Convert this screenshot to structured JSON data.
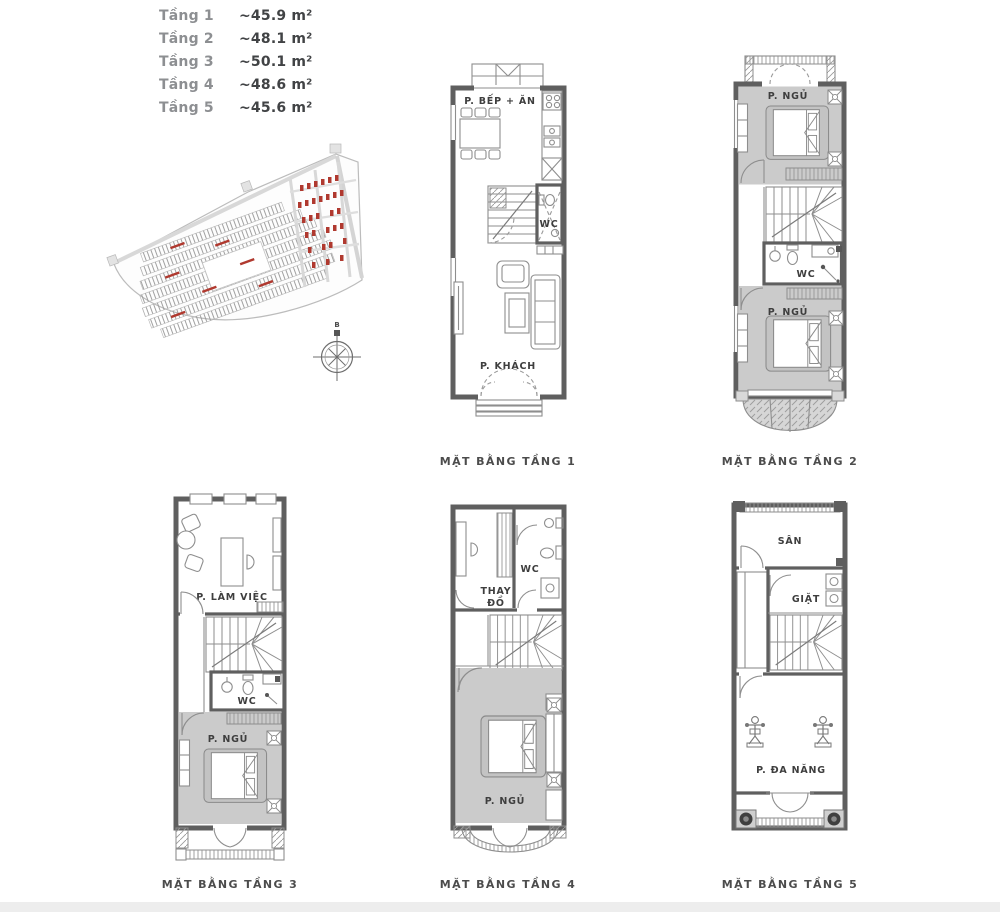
{
  "legend": {
    "rows": [
      {
        "label": "Tầng 1",
        "value": "~45.9 m²"
      },
      {
        "label": "Tầng 2",
        "value": "~48.1 m²"
      },
      {
        "label": "Tầng 3",
        "value": "~50.1 m²"
      },
      {
        "label": "Tầng 4",
        "value": "~48.6 m²"
      },
      {
        "label": "Tầng 5",
        "value": "~45.6 m²"
      }
    ]
  },
  "site_map": {
    "compass_north_label": "B"
  },
  "plans": [
    {
      "caption": "MẶT BẰNG TẦNG 1",
      "labels": {
        "kitchen_dining": "P. BẾP + ĂN",
        "wc": "WC",
        "living": "P. KHÁCH"
      }
    },
    {
      "caption": "MẶT BẰNG TẦNG 2",
      "labels": {
        "bedroom_front": "P. NGỦ",
        "wc": "WC",
        "bedroom_back": "P. NGỦ"
      }
    },
    {
      "caption": "MẶT BẰNG TẦNG 3",
      "labels": {
        "workroom": "P. LÀM VIỆC",
        "wc": "WC",
        "bedroom": "P. NGỦ"
      }
    },
    {
      "caption": "MẶT BẰNG TẦNG 4",
      "labels": {
        "dressing_line1": "THAY",
        "dressing_line2": "ĐỒ",
        "wc": "WC",
        "bedroom": "P. NGỦ"
      }
    },
    {
      "caption": "MẶT BẰNG TẦNG 5",
      "labels": {
        "terrace": "SÂN",
        "laundry": "GIẶT",
        "multipurpose": "P. ĐA NĂNG"
      }
    }
  ],
  "colors": {
    "wall": "#5f5f5f",
    "line": "#8e8e8e",
    "room_fill": "#cbcbcb",
    "accent_red": "#b0392f",
    "text": "#3e3e3e"
  }
}
